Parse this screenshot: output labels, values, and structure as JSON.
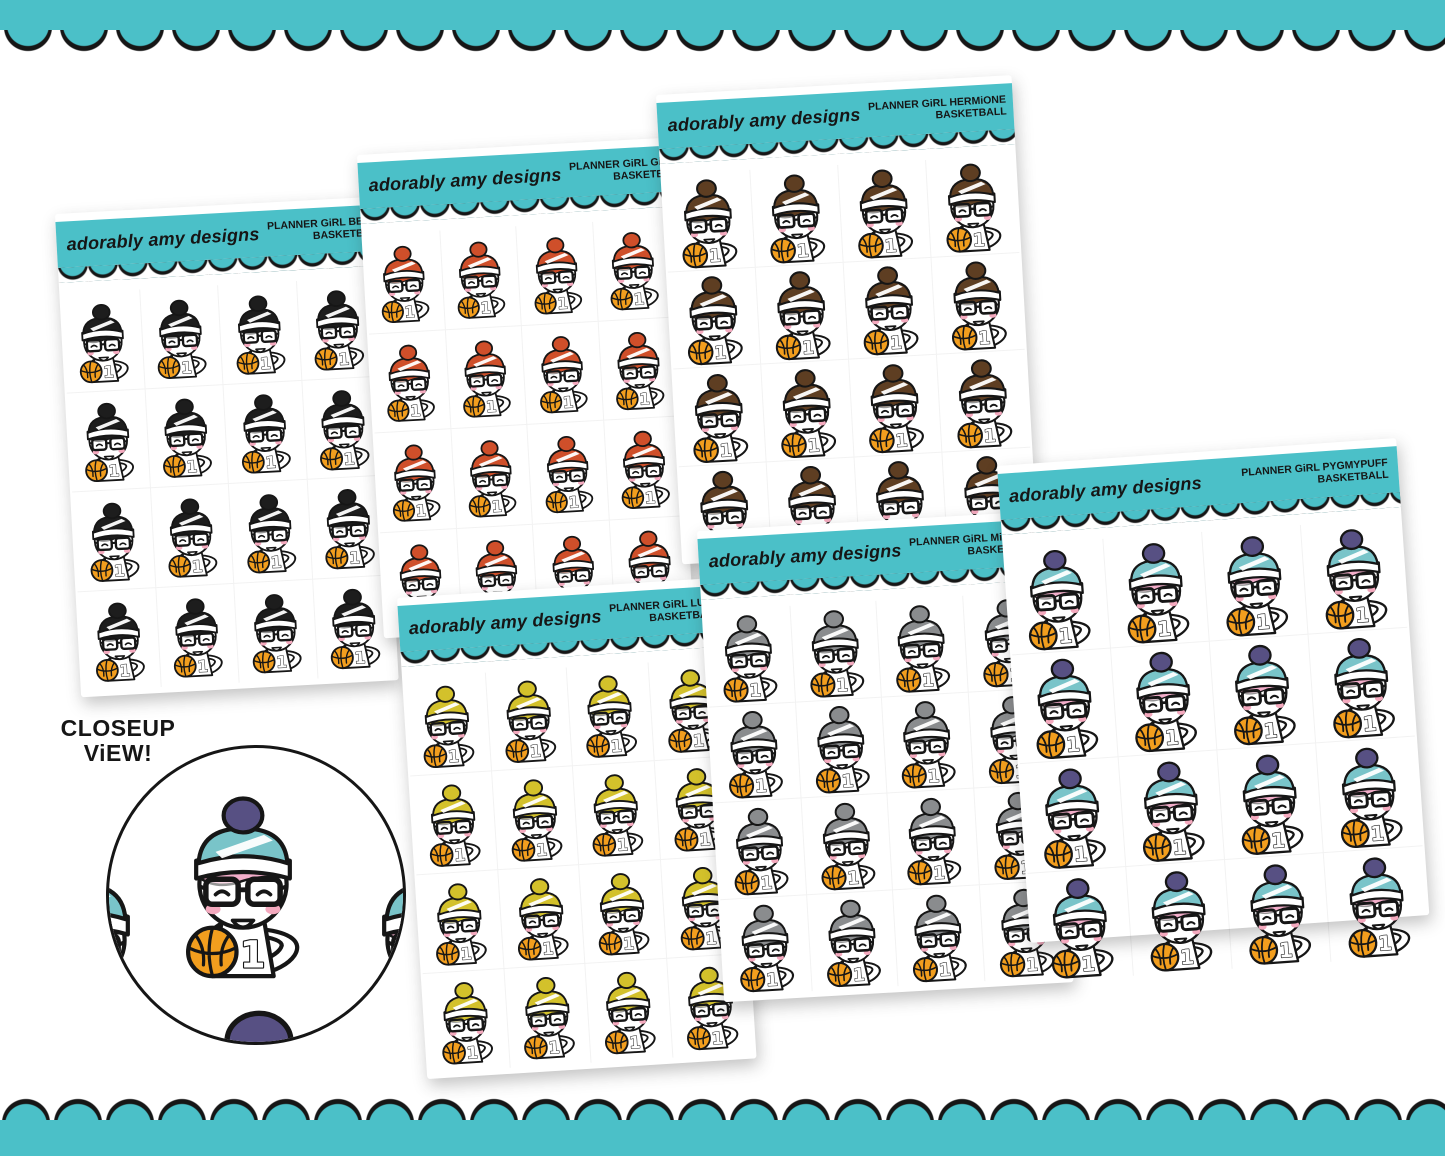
{
  "page": {
    "accent_teal": "#4BC0C8",
    "outline_ink": "#161616",
    "background": "#ffffff"
  },
  "brand": "adorably amy designs",
  "sheets": [
    {
      "id": "bella",
      "title_line1": "PLANNER GiRL BELLA",
      "title_line2": "BASKETBALL",
      "hat": "#1d1d1d",
      "pom": "#1d1d1d",
      "hair": "#1d1d1d"
    },
    {
      "id": "ginny",
      "title_line1": "PLANNER GiRL GiNNY",
      "title_line2": "BASKETBALL",
      "hat": "#cf4f2a",
      "pom": "#cf4f2a",
      "hair": "#cf4f2a"
    },
    {
      "id": "hermione",
      "title_line1": "PLANNER GiRL HERMiONE",
      "title_line2": "BASKETBALL",
      "hat": "#5e3e22",
      "pom": "#5e3e22",
      "hair": "#5e3e22"
    },
    {
      "id": "luna",
      "title_line1": "PLANNER GiRL LUNA",
      "title_line2": "BASKETBALL",
      "hat": "#d3c12b",
      "pom": "#d3c12b",
      "hair": "#d3c12b"
    },
    {
      "id": "minerva",
      "title_line1": "PLANNER GiRL MiNERVA",
      "title_line2": "BASKETBALL",
      "hat": "#8a8c8e",
      "pom": "#8a8c8e",
      "hair": "#8a8c8e"
    },
    {
      "id": "pygmypuff",
      "title_line1": "PLANNER GiRL PYGMYPUFF",
      "title_line2": "BASKETBALL",
      "hat": "#79c4c9",
      "pom": "#575083",
      "hair": "#f3adca"
    }
  ],
  "sticker": {
    "jersey_number": "1",
    "ball_color": "#F29E1E",
    "blush_color": "#F4A9BE"
  },
  "closeup": {
    "label_line1": "CLOSEUP",
    "label_line2": "ViEW!"
  }
}
